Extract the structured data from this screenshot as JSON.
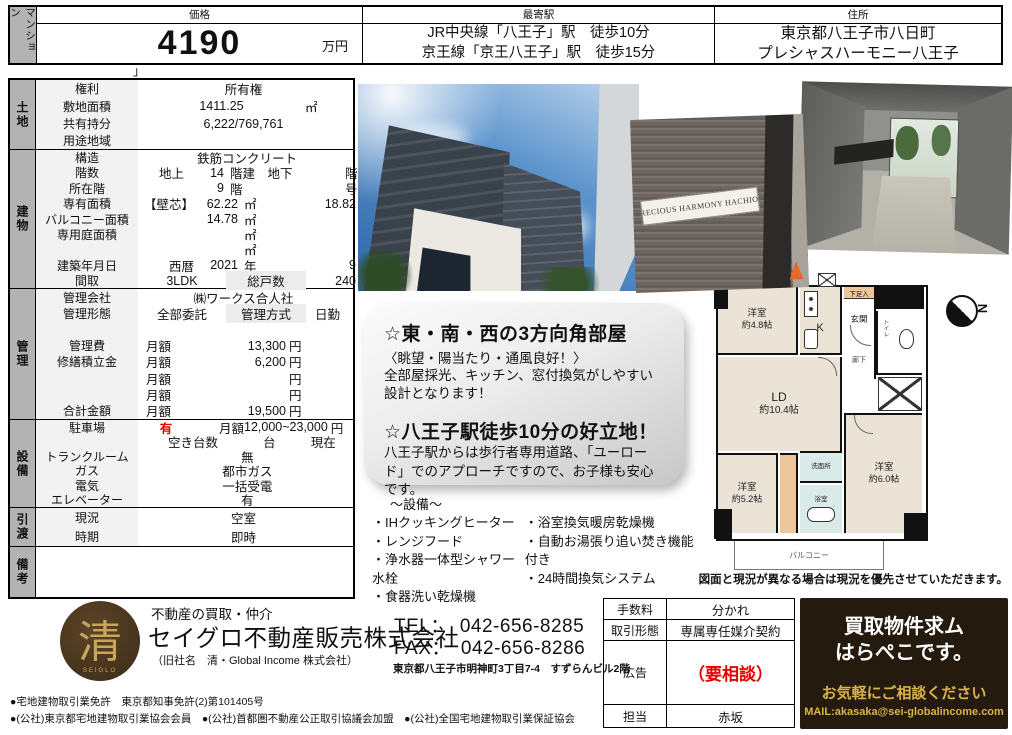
{
  "header": {
    "category": "マンション",
    "price_label": "価格",
    "price_value": "4190",
    "price_unit": "万円",
    "station_label": "最寄駅",
    "station_line1": "JR中央線「八王子」駅　徒歩10分",
    "station_line2": "京王線「京王八王子」駅　徒歩15分",
    "address_label": "住所",
    "address_line1": "東京都八王子市八日町",
    "address_line2": "プレシャスハーモニー八王子",
    "artifact": "」"
  },
  "land": {
    "section": "土地",
    "r1_label": "権利",
    "r1_value": "所有権",
    "r2_label": "敷地面積",
    "r2_value": "1411.25",
    "r2_unit": "㎡",
    "r3_label": "共有持分",
    "r3_value": "6,222/769,761",
    "r4_label": "用途地域"
  },
  "building": {
    "section": "建物",
    "kozo_label": "構造",
    "kozo_value": "鉄筋コンクリート",
    "kozo_unit": "造",
    "kaisu_label": "階数",
    "kaisu_a": "地上",
    "kaisu_b": "14",
    "kaisu_c": "階建　地下",
    "kaisu_e": "階建",
    "shozai_label": "所在階",
    "shozai_b": "9",
    "shozai_c": "階",
    "shozai_e": "号室",
    "senyu_label": "専有面積",
    "senyu_a": "【壁芯】",
    "senyu_b": "62.22",
    "senyu_c": "㎡",
    "senyu_d": "18.82",
    "senyu_e": "坪",
    "balcony_label": "バルコニー面積",
    "balcony_b": "14.78",
    "balcony_c": "㎡",
    "niwa_label": "専用庭面積",
    "niwa_c": "㎡",
    "blank_c": "㎡",
    "chiku_label": "建築年月日",
    "chiku_a": "西暦",
    "chiku_b": "2021",
    "chiku_c": "年",
    "chiku_d": "9",
    "chiku_e": "月",
    "madori_label": "間取",
    "madori_value": "3LDK",
    "soto_label": "総戸数",
    "soto_value": "240",
    "soto_unit": "戸"
  },
  "management": {
    "section": "管理",
    "kaisha_label": "管理会社",
    "kaisha_value": "㈱ワークス合人社",
    "keitai_label": "管理形態",
    "keitai_a": "全部委託",
    "keitai_b": "管理方式",
    "keitai_c": "日勤",
    "hi_label": "管理費",
    "hi_a": "月額",
    "hi_d": "13,300",
    "hi_e": "円",
    "shuzen_label": "修繕積立金",
    "shuzen_a": "月額",
    "shuzen_d": "6,200",
    "shuzen_e": "円",
    "b1_a": "月額",
    "b1_e": "円",
    "b2_a": "月額",
    "b2_e": "円",
    "gokei_label": "合計金額",
    "gokei_a": "月額",
    "gokei_d": "19,500",
    "gokei_e": "円"
  },
  "facility": {
    "section": "設備",
    "parking_label": "駐車場",
    "parking_flag": "有",
    "parking_a": "月額",
    "parking_d": "12,000~23,000",
    "parking_e": "円",
    "aki_a": "空き台数",
    "aki_c": "台",
    "aki_e": "現在",
    "trunk_label": "トランクルーム",
    "trunk_value": "無",
    "gas_label": "ガス",
    "gas_value": "都市ガス",
    "denki_label": "電気",
    "denki_value": "一括受電",
    "elev_label": "エレベーター",
    "elev_value": "有"
  },
  "handover": {
    "section": "引渡",
    "genkyo_label": "現況",
    "genkyo_value": "空室",
    "jiki_label": "時期",
    "jiki_value": "即時"
  },
  "remarks": {
    "section": "備考"
  },
  "features": {
    "h1": "☆東・南・西の3方向角部屋",
    "s1": "〈眺望・陽当たり・通風良好！〉",
    "b1": "全部屋採光、キッチン、窓付換気がしやすい設計となります！",
    "h2": "☆八王子駅徒歩10分の好立地！",
    "b2": "八王子駅からは歩行者専用道路、「ユーロード」でのアプローチですので、お子様も安心です。"
  },
  "equipment": {
    "title": "〜設備〜",
    "left": [
      "・IHクッキングヒーター",
      "・レンジフード",
      "・浄水器一体型シャワー水栓",
      "・食器洗い乾燥機"
    ],
    "right": [
      "・浴室換気暖房乾燥機",
      "・自動お湯張り追い焚き機能付き",
      "・24時間換気システム"
    ]
  },
  "floorplan": {
    "yoshitsu48": "洋室",
    "yoshitsu48_size": "約4.8帖",
    "k": "K",
    "geta": "下足入",
    "genkan": "玄関",
    "roka": "廊下",
    "toilet": "トイレ",
    "ld": "LD",
    "ld_size": "約10.4帖",
    "yoshitsu52": "洋室",
    "yoshitsu52_size": "約5.2帖",
    "senmen": "洗面所",
    "yokushitsu": "浴室",
    "yoshitsu60": "洋室",
    "yoshitsu60_size": "約6.0帖",
    "balcony": "バルコニー",
    "compass": "N",
    "note": "図面と現況が異なる場合は現況を優先させていただきます。"
  },
  "photos": {
    "sign_text": "PRECIOUS HARMONY HACHIOJI"
  },
  "company": {
    "tagline": "不動産の買取・仲介",
    "name": "セイグロ不動産販売株式会社",
    "former": "（旧社名　清・Global Income 株式会社）",
    "logo_char": "清",
    "logo_sub": "SEIGLO",
    "tel": "TEL：　042-656-8285",
    "fax": "FAX：　042-656-8286",
    "office_address": "東京都八王子市明神町3丁目7-4　すずらんビル2階",
    "license1": "●宅地建物取引業免許　東京都知事免許(2)第101405号",
    "license2": "●(公社)東京都宅地建物取引業協会会員　●(公社)首都圏不動産公正取引協議会加盟　●(公社)全国宅地建物取引業保証協会"
  },
  "deal": {
    "fee_label": "手数料",
    "fee_value": "分かれ",
    "type_label": "取引形態",
    "type_value": "専属専任媒介契約",
    "ad_label": "広告",
    "ad_value": "（要相談）",
    "staff_label": "担当",
    "staff_value": "赤坂"
  },
  "promo": {
    "line1": "買取物件求ム",
    "line2": "はらぺこです。",
    "line3": "お気軽にご相談ください",
    "mail": "MAIL:akasaka@sei-globalincome.com"
  },
  "colors": {
    "accent_red": "#e60000",
    "gold": "#d9b24a",
    "dark_brown": "#241b0e",
    "section_gray": "#b3b3b3",
    "label_gray": "#f2f2f2"
  }
}
